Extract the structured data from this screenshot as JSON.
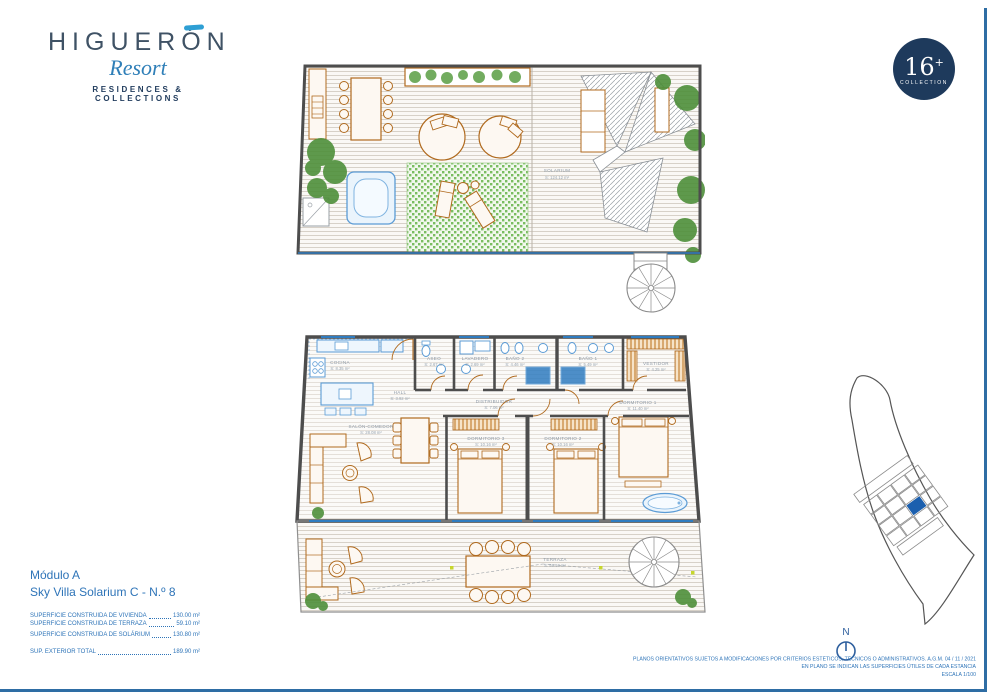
{
  "colors": {
    "frame_blue": "#2e6da4",
    "brand_navy": "#1e3a5c",
    "brand_slate": "#3f5265",
    "brand_blue": "#2f7fb8",
    "text_blue": "#2e74b8",
    "wall_gray": "#4d4d4d",
    "furniture_orange": "#b06a1e",
    "fixture_blue": "#5b9bd5",
    "window_blue": "#2f7cc0",
    "plant_green": "#4e8f3a",
    "site_highlight": "#1b5fae"
  },
  "brand": {
    "logo_title": "HIGUERÓN",
    "logo_script": "Resort",
    "logo_tagline": "RESIDENCES & COLLECTIONS",
    "badge_number": "16",
    "badge_plus": "+",
    "badge_label": "COLLECTION"
  },
  "unit": {
    "module": "Módulo A",
    "name": "Sky Villa Solarium C - N.º 8",
    "areas": [
      {
        "label": "SUPERFICIE CONSTRUIDA DE VIVIENDA",
        "value": "130.00 m²"
      },
      {
        "label": "SUPERFICIE CONSTRUIDA DE TERRAZA",
        "value": "59.10 m²"
      },
      {
        "label": "SUPERFICIE CONSTRUIDA DE SOLÁRIUM",
        "value": "130.80 m²"
      },
      {
        "label": "SUP. EXTERIOR TOTAL",
        "value": "189.90 m²"
      }
    ]
  },
  "plans": {
    "solarium_rooms": [
      {
        "name": "SOLARIUM",
        "area": "S: 124.12 m²"
      }
    ],
    "main_rooms": [
      {
        "name": "COCINA",
        "area": "S: 8.35 m²"
      },
      {
        "name": "ASEO",
        "area": "S: 2.67 m²"
      },
      {
        "name": "LAVADERO",
        "area": "S: 2.69 m²"
      },
      {
        "name": "BAÑO 2",
        "area": "S: 4.46 m²"
      },
      {
        "name": "BAÑO 1",
        "area": "S: 5.49 m²"
      },
      {
        "name": "VESTIDOR",
        "area": "S: 4.25 m²"
      },
      {
        "name": "HALL",
        "area": "S: 3.92 m²"
      },
      {
        "name": "DISTRIBUIDOR",
        "area": "S: 7.06 m²"
      },
      {
        "name": "DORMITORIO 1",
        "area": "S: 11.40 m²"
      },
      {
        "name": "SALÓN-COMEDOR",
        "area": "S: 28.08 m²"
      },
      {
        "name": "DORMITORIO 3",
        "area": "S: 10.16 m²"
      },
      {
        "name": "DORMITORIO 2",
        "area": "S: 10.16 m²"
      },
      {
        "name": "TERRAZA",
        "area": "S: 59.10 m²"
      }
    ]
  },
  "footer": {
    "compass_label": "N",
    "disclaimer_line1": "PLANOS ORIENTATIVOS SUJETOS A MODIFICACIONES POR CRITERIOS ESTÉTICOS, TÉCNICOS O ADMINISTRATIVOS. A.G.M. 04 / 11 / 2021",
    "disclaimer_line2": "EN PLANO SE INDICAN LAS SUPERFICIES ÚTILES DE CADA ESTANCIA",
    "disclaimer_line3": "ESCALA 1/100"
  }
}
